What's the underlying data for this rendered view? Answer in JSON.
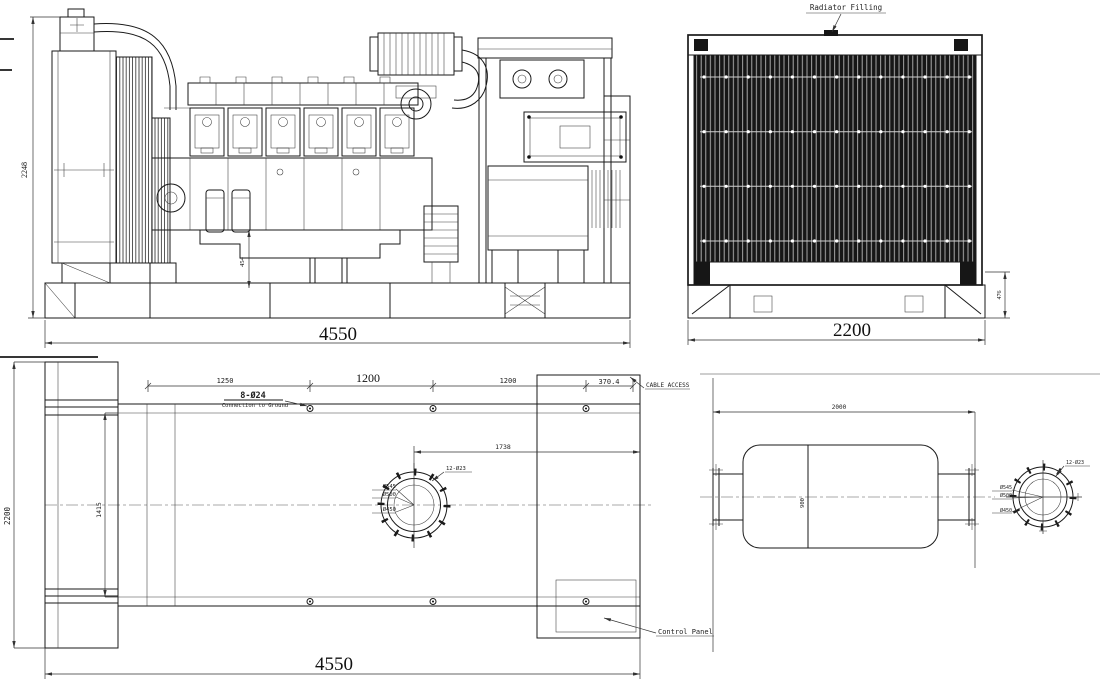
{
  "side_view": {
    "overall_height": "2248",
    "overall_length": "4550",
    "oil_drain_offset": "454"
  },
  "rear_view": {
    "overall_width": "2200",
    "base_height": "476",
    "radiator_filling": "Radiator Filling"
  },
  "plan_view": {
    "overall_length": "4550",
    "overall_width": "2200",
    "mount_rail_span": "1415",
    "exhaust_offset": "1738",
    "chain": [
      "1250",
      "1200",
      "1200",
      "370.4"
    ],
    "cable_access": "CABLE ACCESS",
    "control_panel": "Control Panel",
    "foundation_holes": "8-Ø24",
    "connection_ground": "Connection to Ground",
    "exhaust_flange": {
      "bolts": "12-Ø23",
      "outer_dia": "Ø545",
      "bolt_circle_dia": "Ø500",
      "inner_dia": "Ø450"
    }
  },
  "muffler_view": {
    "overall_length": "2000",
    "body_width": "900",
    "flange": {
      "bolts": "12-Ø23",
      "outer_dia": "Ø545",
      "bolt_circle_dia": "Ø500",
      "inner_dia": "Ø450"
    }
  }
}
